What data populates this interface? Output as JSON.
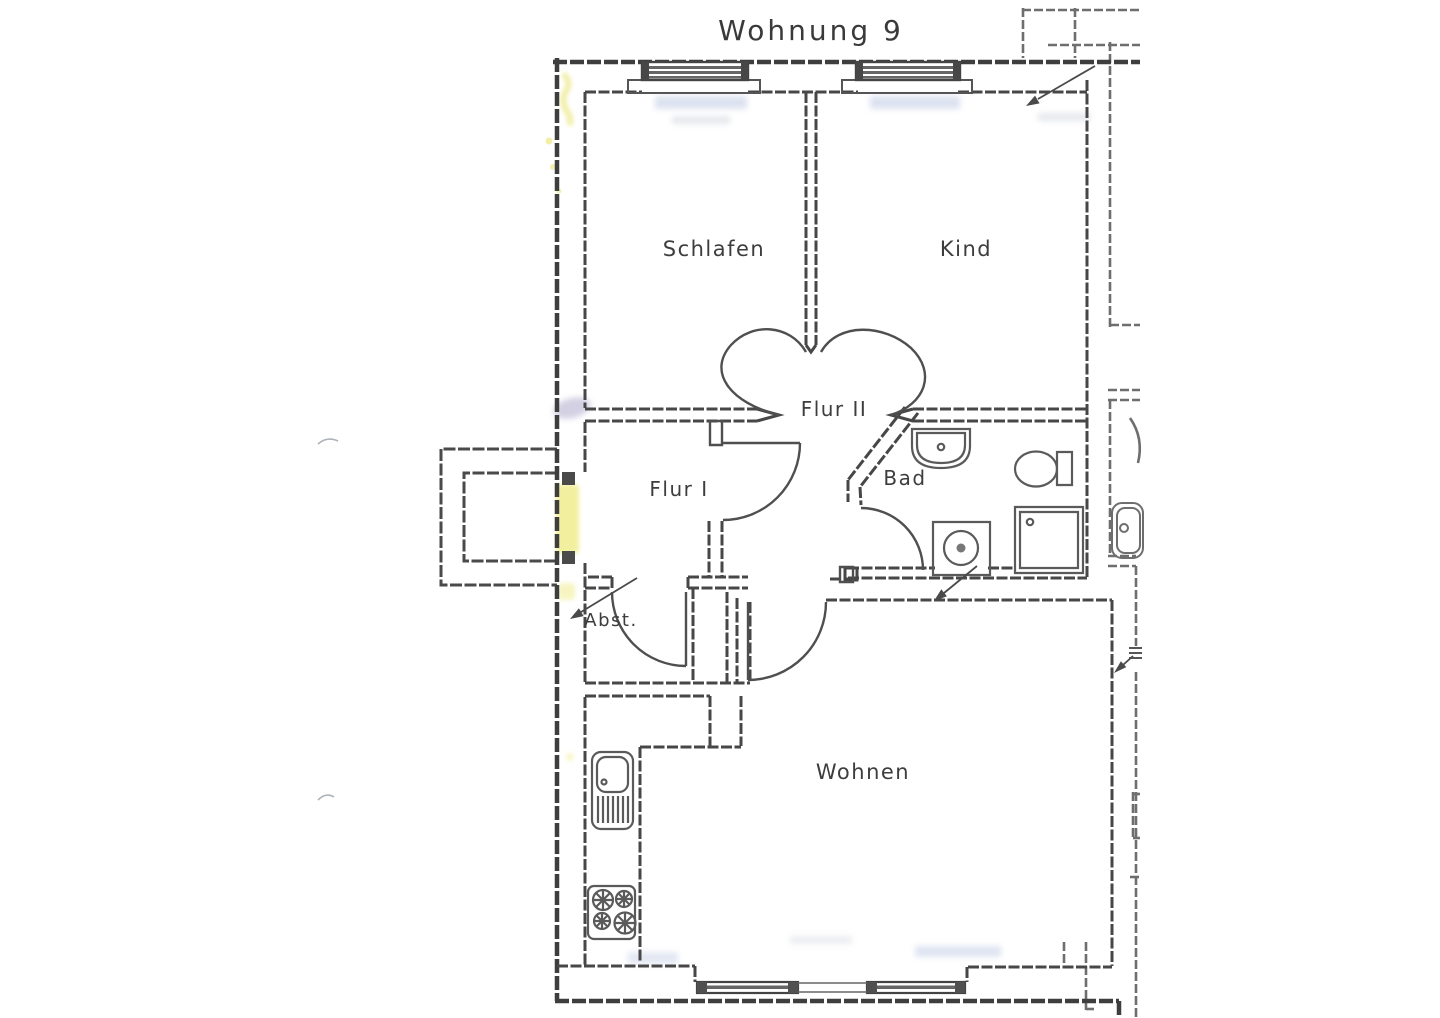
{
  "document": {
    "title": "Wohnung 9",
    "kind": "floor-plan-scan"
  },
  "rooms": {
    "schlafen": {
      "label": "Schlafen"
    },
    "kind": {
      "label": "Kind"
    },
    "flur2": {
      "label": "Flur II"
    },
    "flur1": {
      "label": "Flur I"
    },
    "bad": {
      "label": "Bad"
    },
    "abst": {
      "label": "Abst."
    },
    "wohnen": {
      "label": "Wohnen"
    }
  },
  "fixtures": [
    "kitchen-sink-icon",
    "stove-icon",
    "bathroom-sink-icon",
    "toilet-icon",
    "shower-icon",
    "washing-machine-icon",
    "neighbor-sink-icon"
  ],
  "annotations": {
    "door_arrows": 4,
    "entrance_highlight": "yellow highlighter on entrance door in left wall"
  },
  "colors": {
    "wall_line": "#454545",
    "fixture_line": "#5a5a5a",
    "neighbor_line": "#6e6e6e",
    "highlight_yellow": "#e6e14f",
    "smudge_blue": "#b9c6e2",
    "smudge_purple": "#948ab8",
    "paper": "#ffffff"
  }
}
